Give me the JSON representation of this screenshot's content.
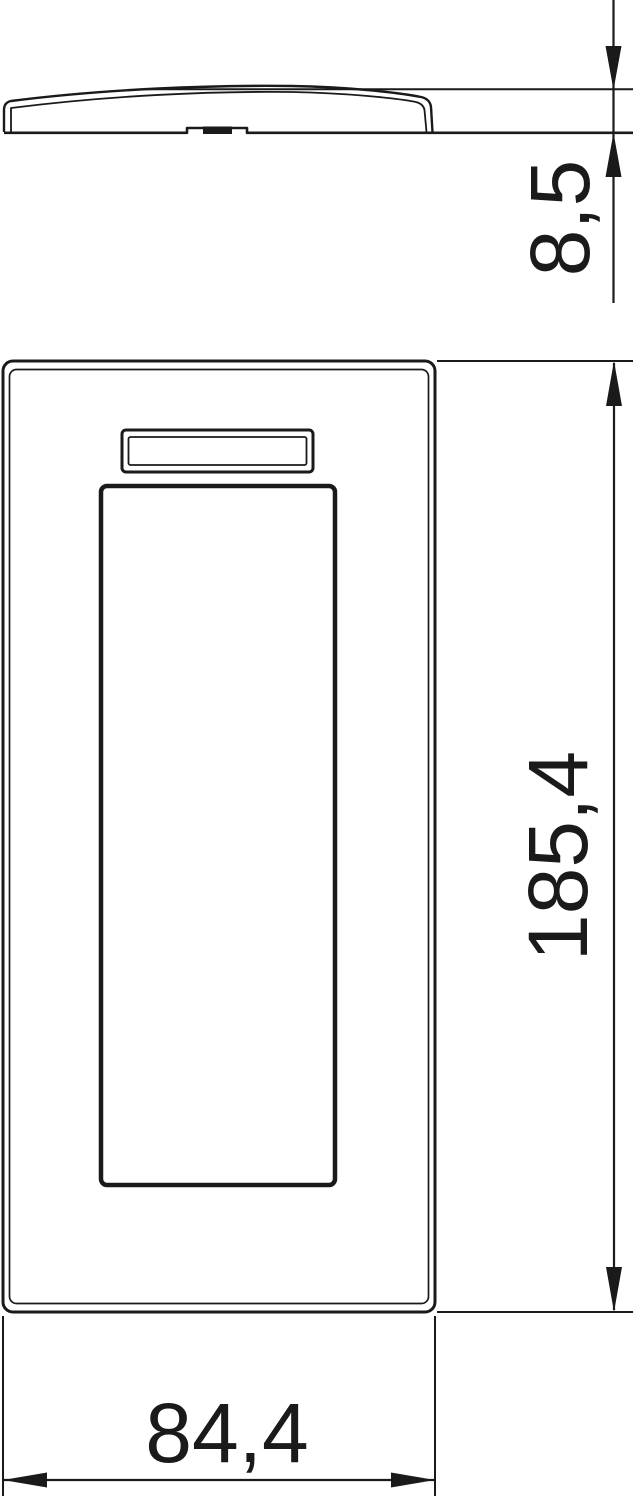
{
  "drawing": {
    "background": "#ffffff",
    "line_color": "#1a1a1a",
    "dim_labels": {
      "thickness": "8,5",
      "height": "185,4",
      "width": "84,4"
    }
  }
}
